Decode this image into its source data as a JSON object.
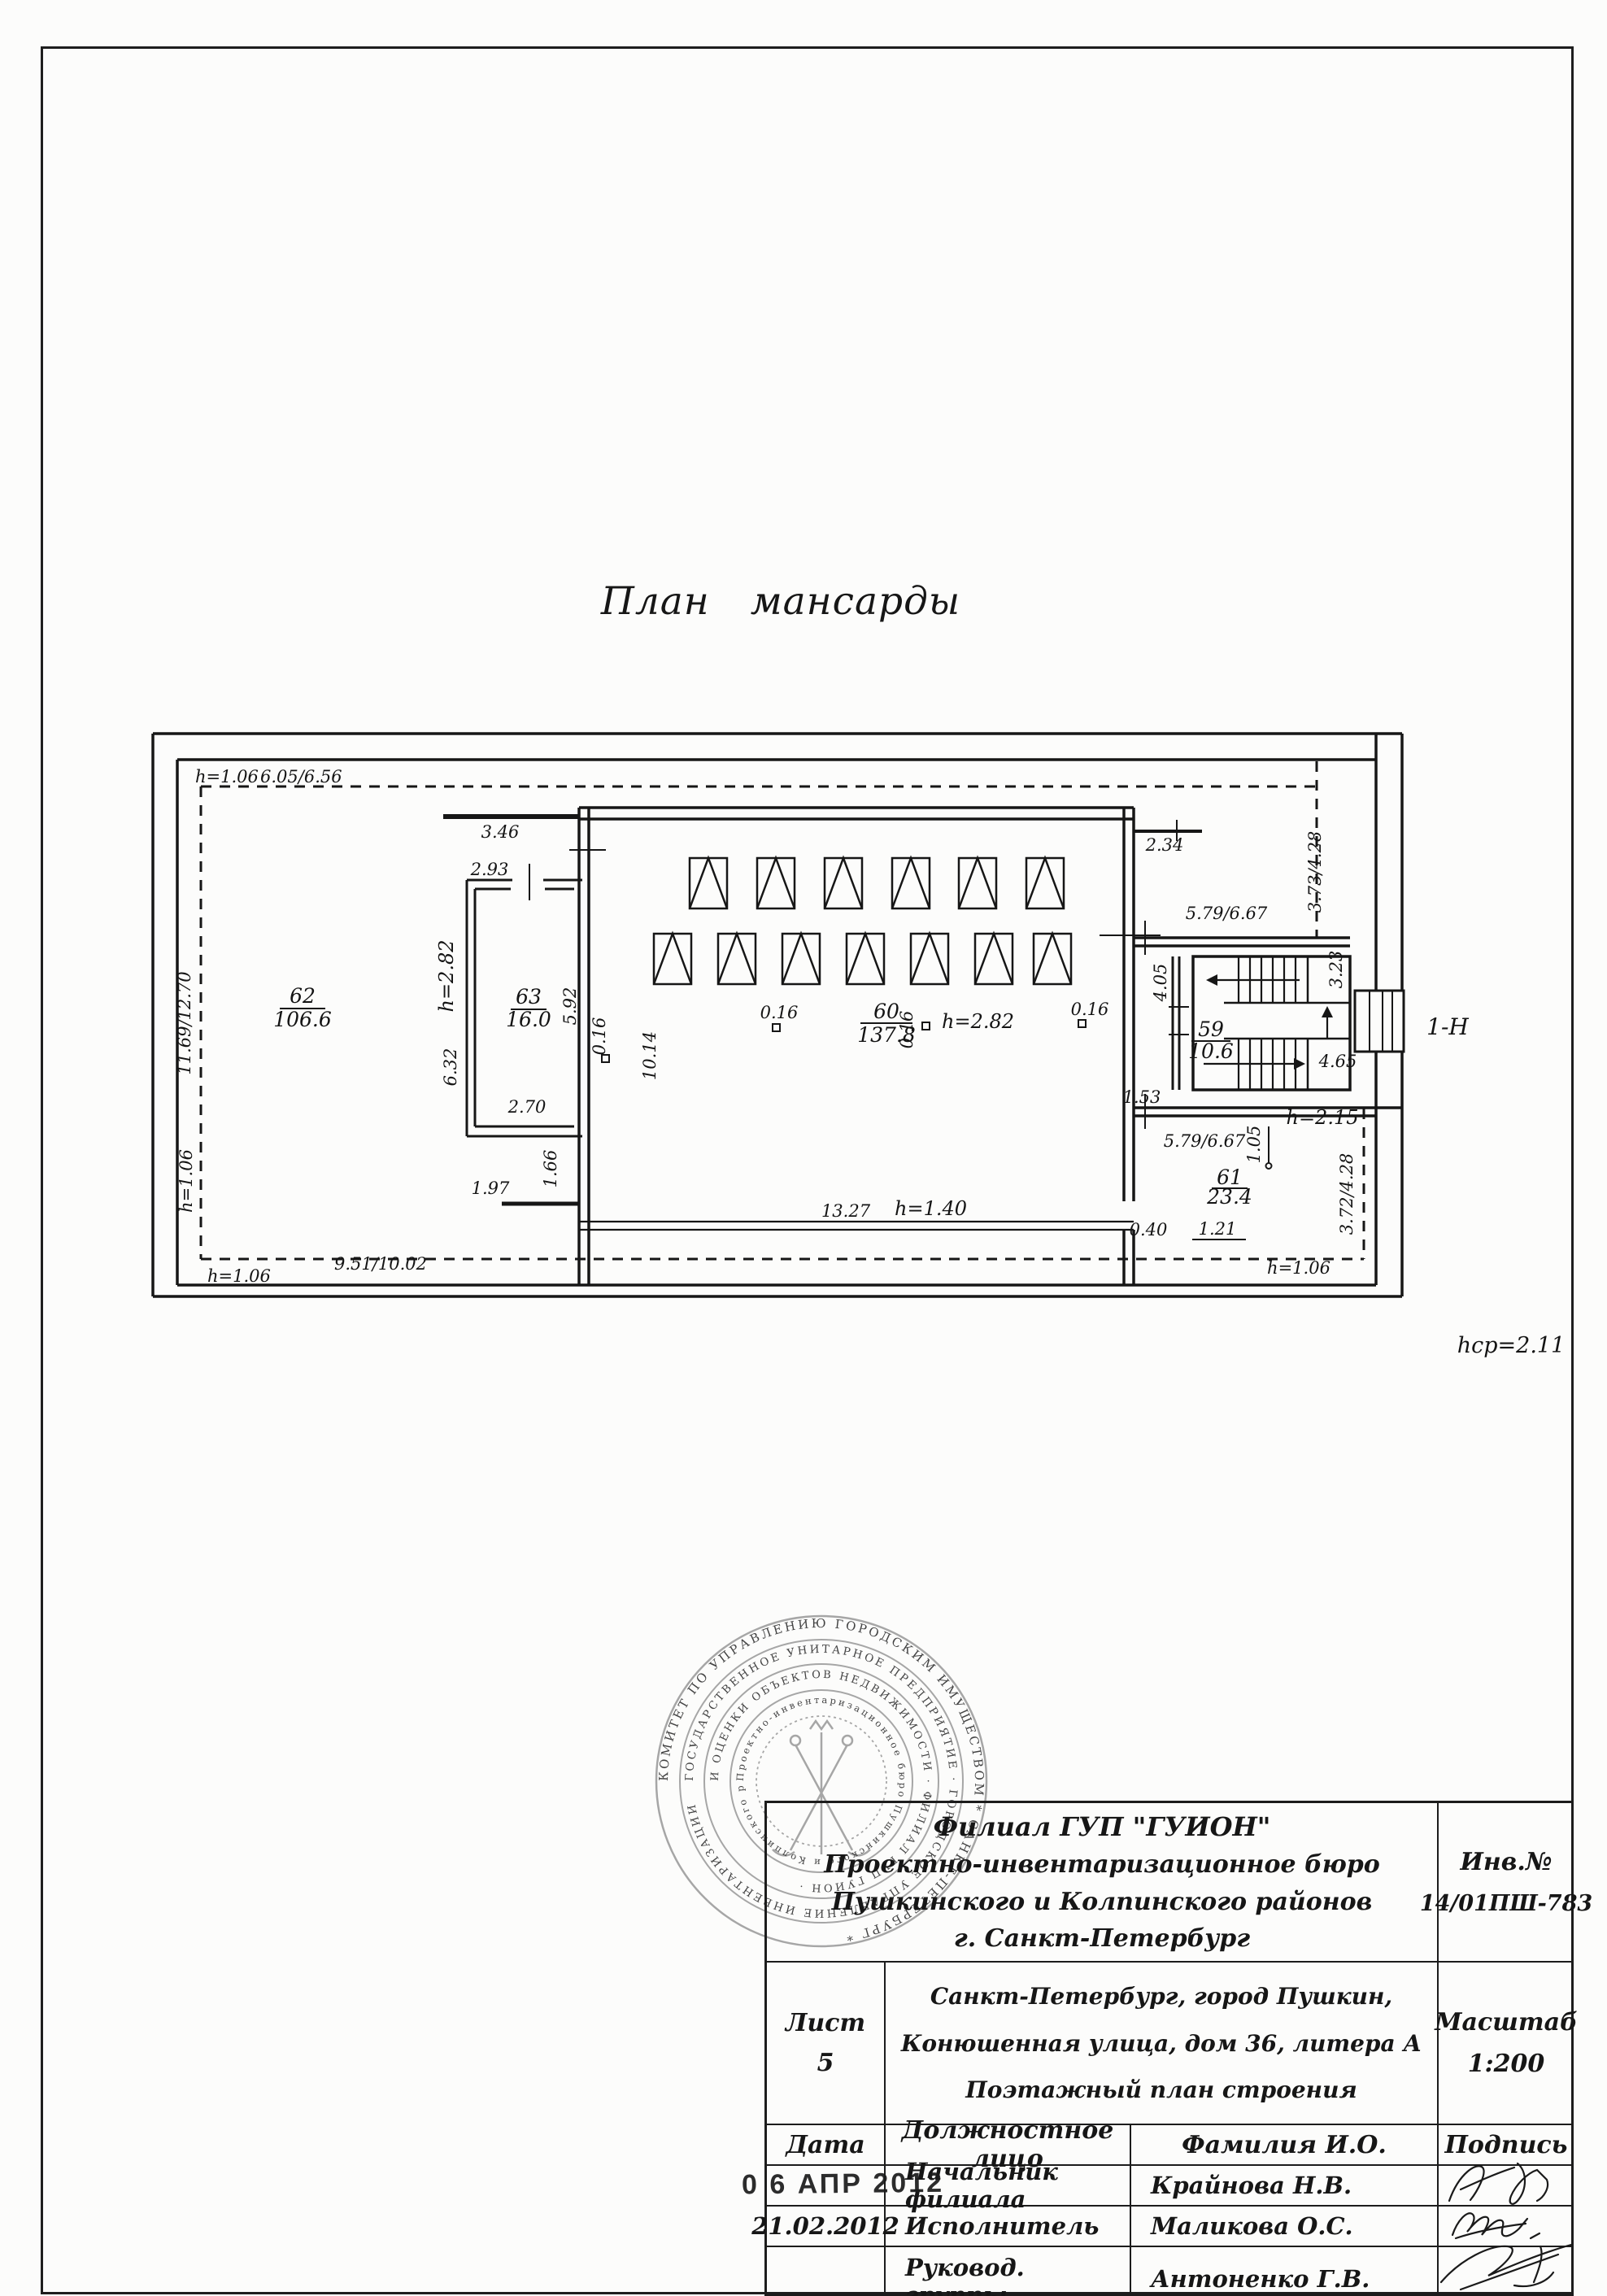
{
  "page": {
    "title": "План  мансарды",
    "avg_height": "hср=2.11",
    "entrance_label": "1-Н"
  },
  "plan": {
    "rooms": {
      "r62": {
        "num": "62",
        "area": "106.6"
      },
      "r63": {
        "num": "63",
        "area": "16.0"
      },
      "r60": {
        "num": "60",
        "area": "137.8"
      },
      "r59": {
        "num": "59",
        "area": "10.6"
      },
      "r61": {
        "num": "61",
        "area": "23.4"
      }
    },
    "dims": {
      "h106": "h=1.06",
      "d605": "6.05/6.56",
      "d1169": "11.69/12.70",
      "d951": "9.51/10.02",
      "d346": "3.46",
      "d293": "2.93",
      "h282": "h=2.82",
      "d632": "6.32",
      "d592": "5.92",
      "d270": "2.70",
      "d016": "0.16",
      "d1014": "10.14",
      "d197": "1.97",
      "d166": "1.66",
      "d1327": "13.27",
      "h140": "h=1.40",
      "d234": "2.34",
      "d373": "3.73/4.28",
      "d579": "5.79/6.67",
      "d405": "4.05",
      "d323": "3.23",
      "d465": "4.65",
      "d153": "1.53",
      "h215": "h=2.15",
      "d105": "1.05",
      "d372": "3.72/4.28",
      "d121": "1.21",
      "d040": "0.40"
    }
  },
  "seal": {
    "ring1": "КОМИТЕТ ПО УПРАВЛЕНИЮ ГОРОДСКИМ ИМУЩЕСТВОМ  *  САНКТ-ПЕТЕРБУРГ  *",
    "ring2": "ГОСУДАРСТВЕННОЕ УНИТАРНОЕ ПРЕДПРИЯТИЕ · ГОРОДСКОЕ УПРАВЛЕНИЕ ИНВЕНТАРИЗАЦИИ",
    "ring3": "И ОЦЕНКИ ОБЪЕКТОВ НЕДВИЖИМОСТИ · ФИЛИАЛ ГУП ГУИОН ·",
    "ring4": "Проектно-инвентаризационное бюро Пушкинского и Колпинского районов"
  },
  "title_block": {
    "org_lines": [
      "Филиал ГУП \"ГУИОН\"",
      "Проектно-инвентаризационное бюро",
      "Пушкинского и Колпинского районов",
      "г. Санкт-Петербург"
    ],
    "inv_label": "Инв.№",
    "inv_value": "14/01ПШ-783",
    "sheet_label": "Лист",
    "sheet_value": "5",
    "address_lines": [
      "Санкт-Петербург, город Пушкин,",
      "Конюшенная улица, дом 36, литера А",
      "Поэтажный план строения"
    ],
    "scale_label": "Масштаб",
    "scale_value": "1:200",
    "headers": {
      "date": "Дата",
      "official": "Должностное лицо",
      "name": "Фамилия И.О.",
      "signature": "Подпись"
    },
    "date_stamp": "0 6 АПР 2012",
    "rows": [
      {
        "date": "",
        "official": "Начальник филиала",
        "name": "Крайнова Н.В."
      },
      {
        "date": "21.02.2012",
        "official": "Исполнитель",
        "name": "Маликова О.С."
      },
      {
        "date": "",
        "official": "Руковод. группы",
        "name": "Антоненко Г.В."
      }
    ]
  }
}
